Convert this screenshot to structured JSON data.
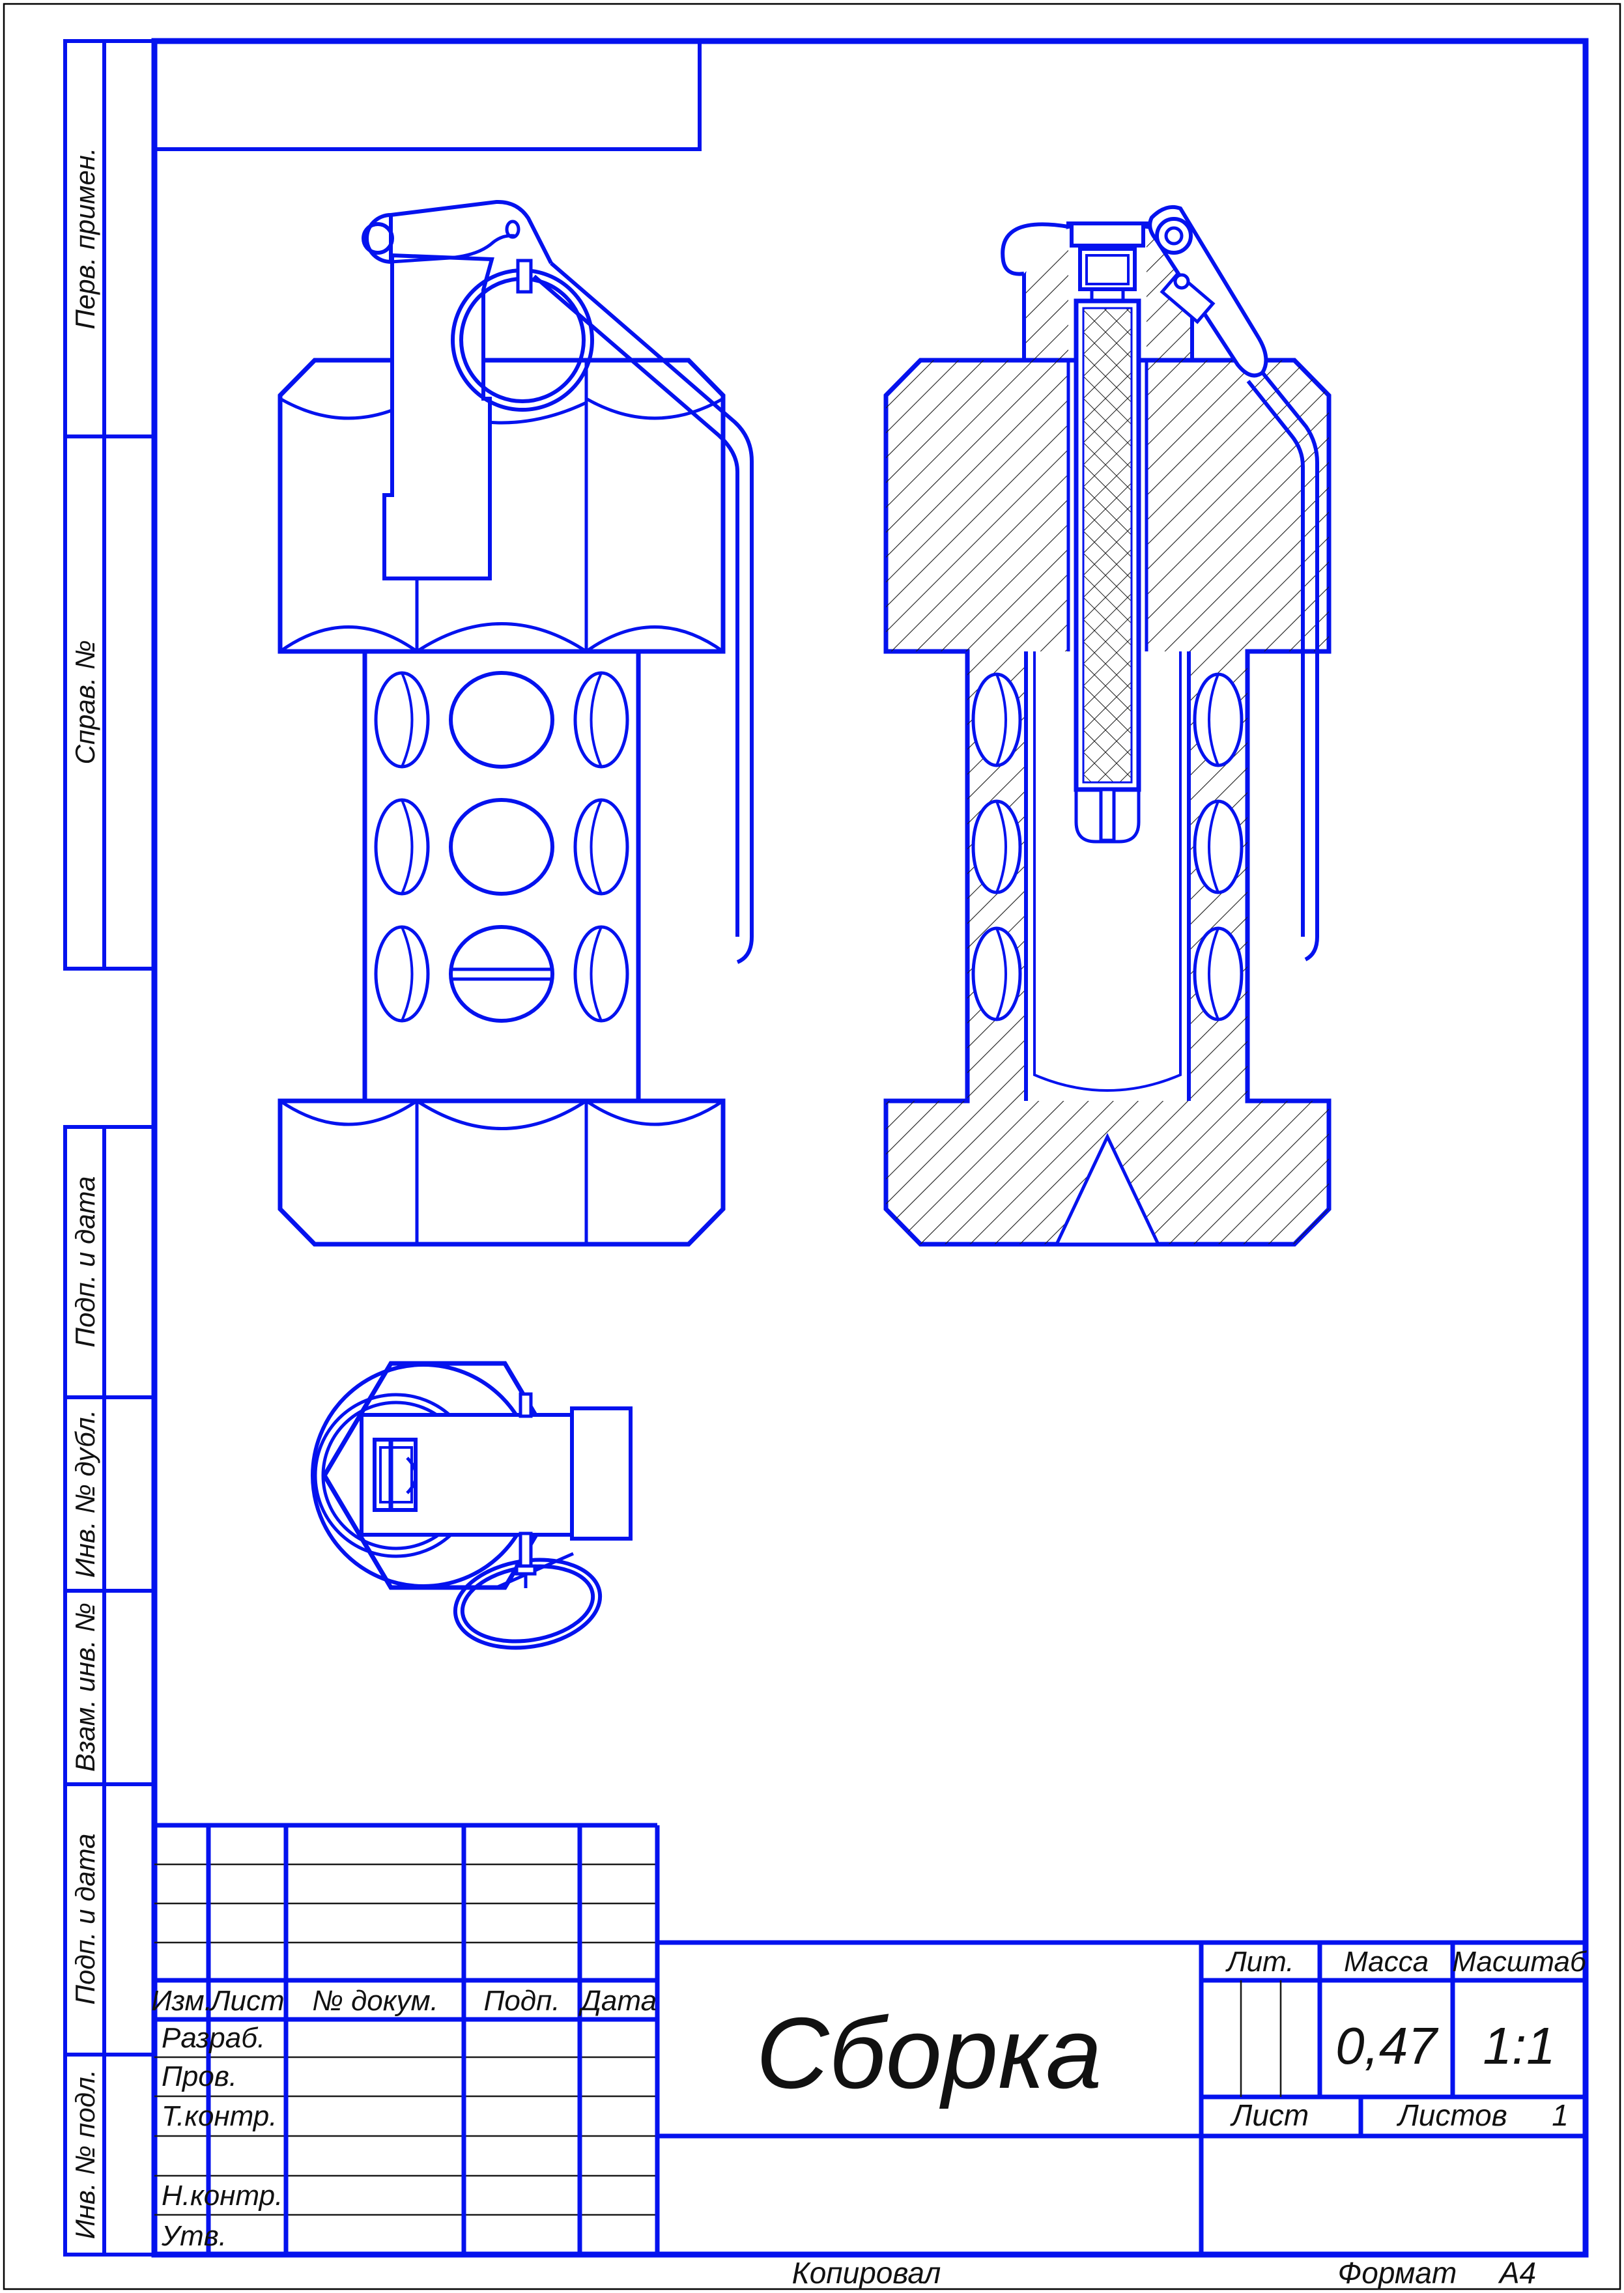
{
  "page": {
    "background": "#ffffff",
    "line_color": "#0412ee",
    "hatch_color": "#1a1a1a",
    "text_color": "#111111"
  },
  "margin_labels": {
    "perv_primen": "Перв. примен.",
    "sprav_no": "Справ. №",
    "podp_i_data_upper": "Подп. и дата",
    "inv_no_dubl": "Инв. № дубл.",
    "vzam_inv_no": "Взам. инв. №",
    "podp_i_data_lower": "Подп. и дата",
    "inv_no_podl": "Инв. № подл."
  },
  "title_block": {
    "change_header": {
      "izm": "Изм.",
      "list": "Лист",
      "doc_no": "№ докум.",
      "podp": "Подп.",
      "data": "Дата"
    },
    "signature_rows": {
      "razrab": "Разраб.",
      "prov": "Пров.",
      "t_kontr": "Т.контр.",
      "n_kontr": "Н.контр.",
      "utv": "Утв."
    },
    "doc_title": "Сборка",
    "lit_label": "Лит.",
    "mass_label": "Масса",
    "scale_label": "Масштаб",
    "mass_value": "0,47",
    "scale_value": "1:1",
    "sheet_label": "Лист",
    "sheets_label": "Листов",
    "sheets_value": "1"
  },
  "footer": {
    "copied_label": "Копировал",
    "format_label": "Формат",
    "format_value": "А4"
  },
  "drawing": {
    "views": {
      "front_view": "grenade-front-view",
      "section_view": "grenade-section-view",
      "top_view": "grenade-top-view"
    }
  }
}
